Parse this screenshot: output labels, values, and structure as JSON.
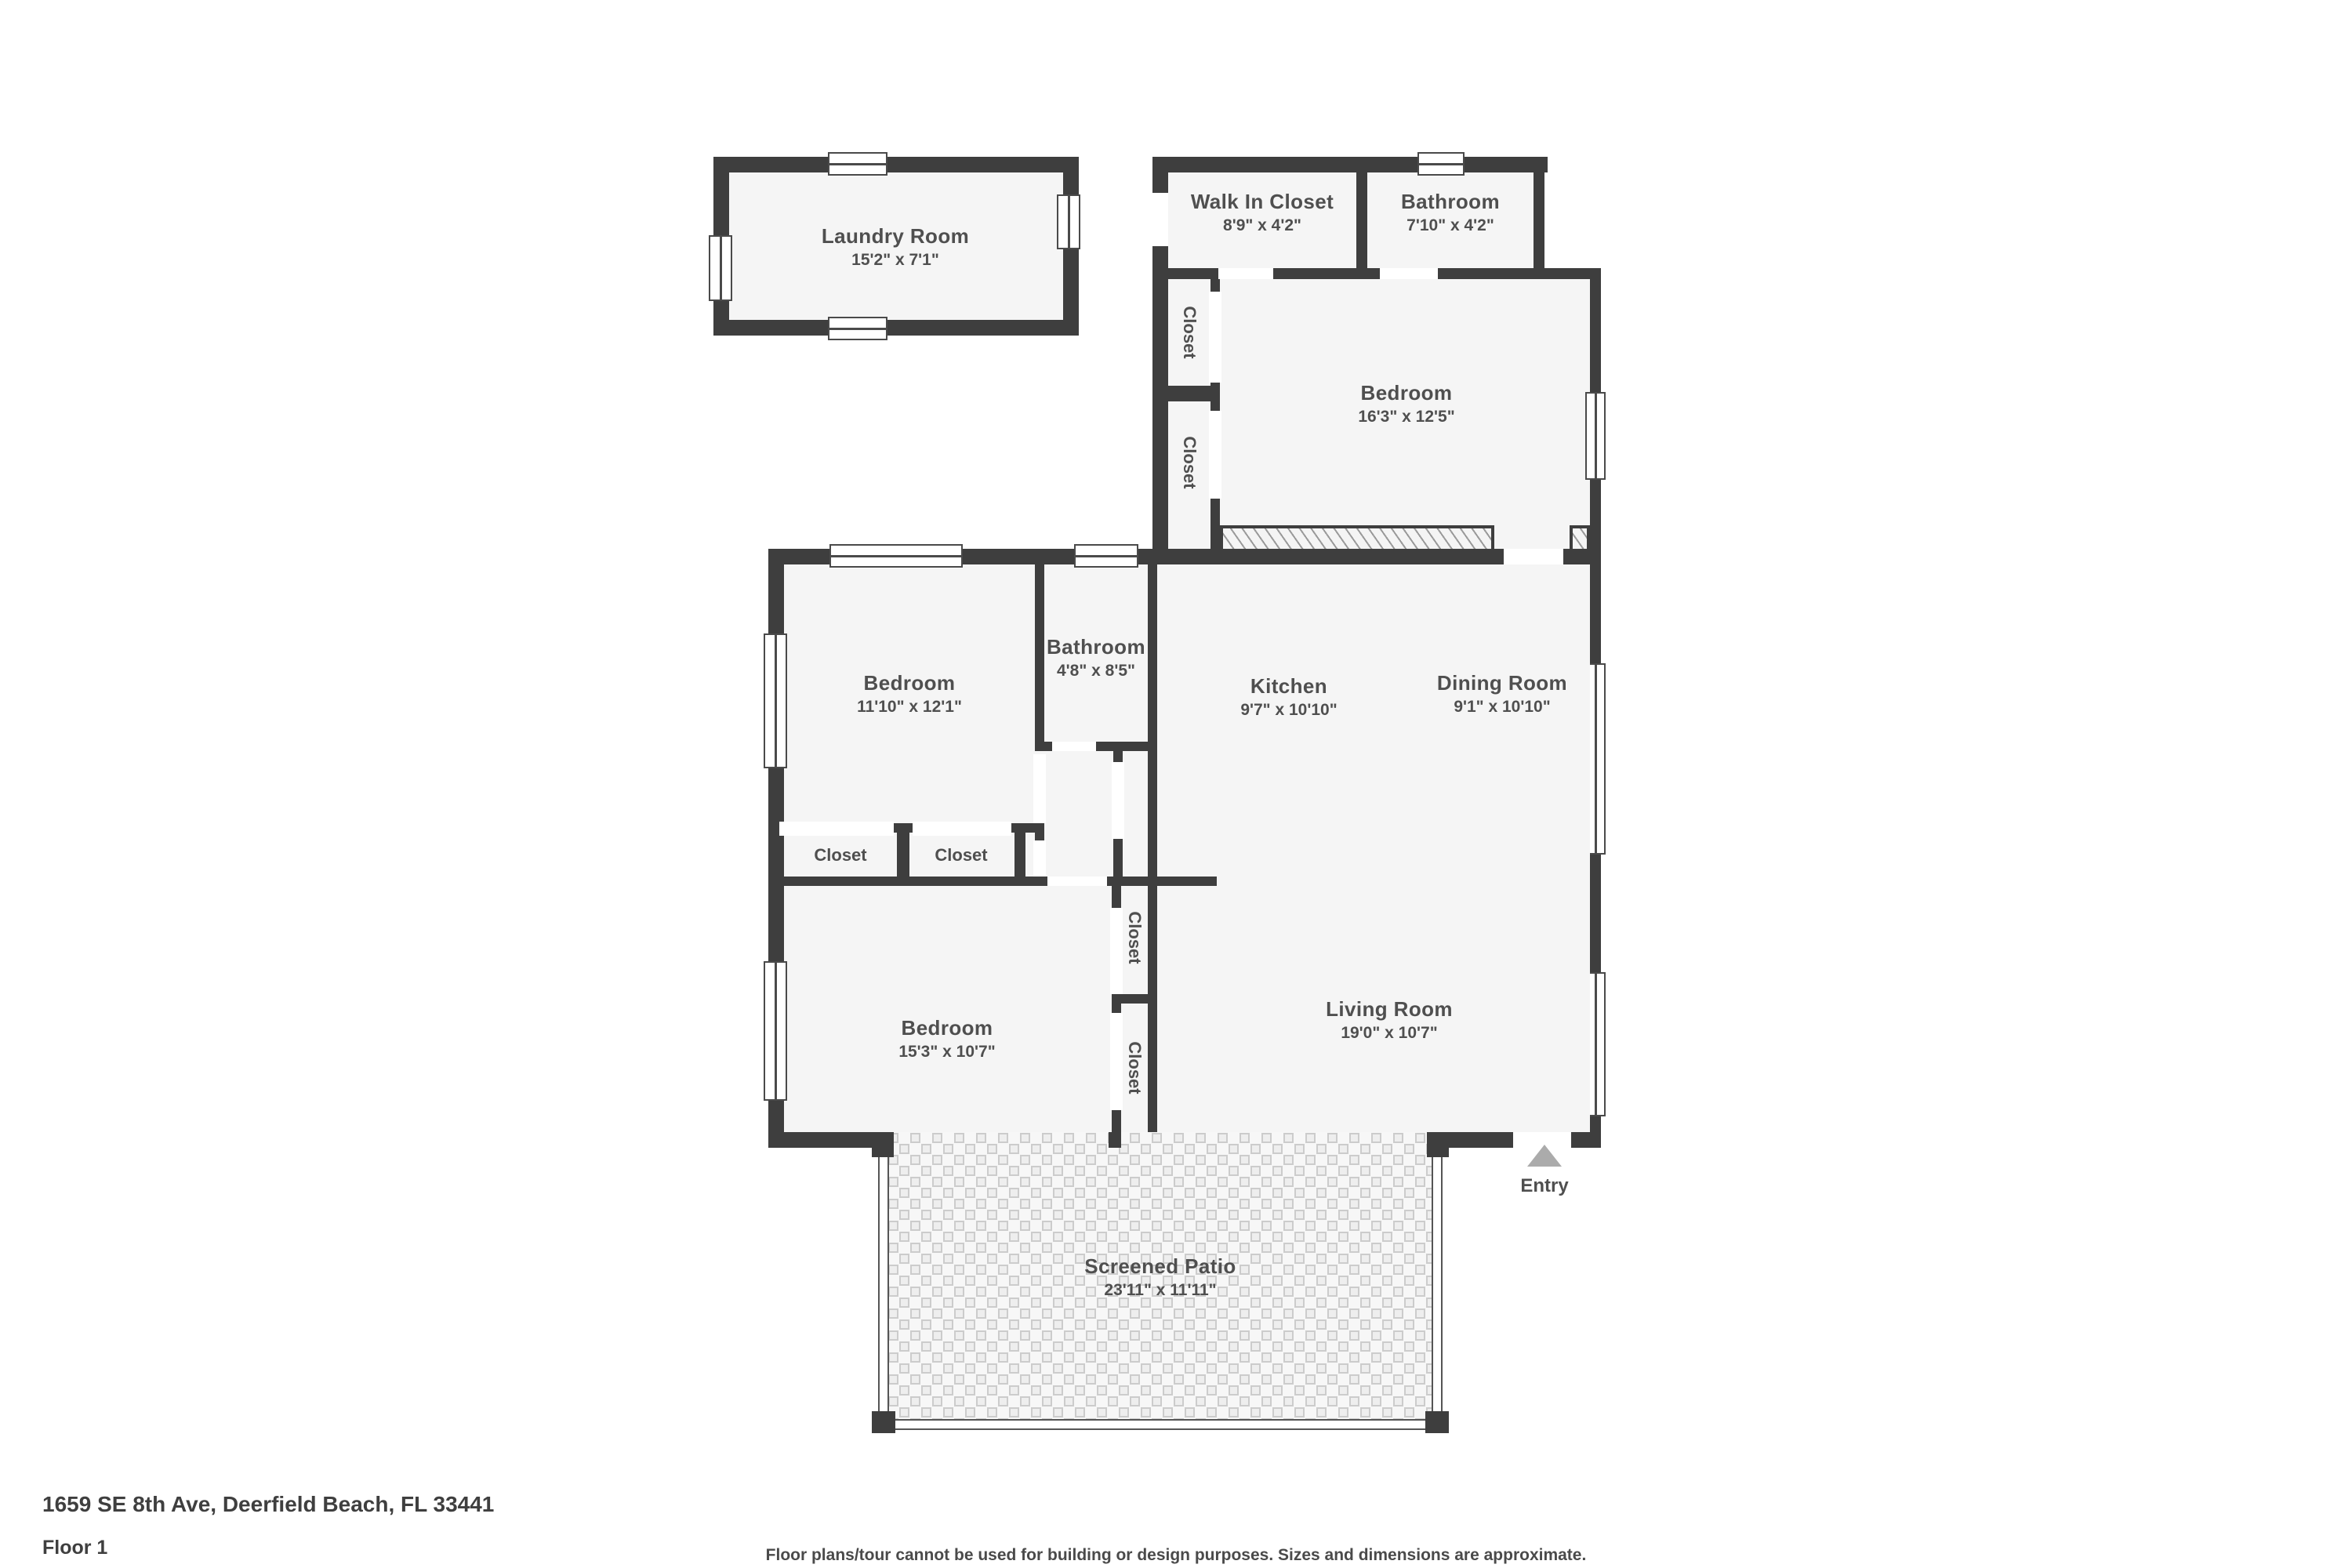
{
  "plan": {
    "rooms": {
      "laundry": {
        "name": "Laundry Room",
        "dims": "15'2\" x 7'1\""
      },
      "walk_in_closet": {
        "name": "Walk In Closet",
        "dims": "8'9\" x 4'2\""
      },
      "bathroom_top": {
        "name": "Bathroom",
        "dims": "7'10\" x 4'2\""
      },
      "bedroom_top": {
        "name": "Bedroom",
        "dims": "16'3\" x 12'5\""
      },
      "bedroom_mid": {
        "name": "Bedroom",
        "dims": "11'10\" x 12'1\""
      },
      "bathroom_small": {
        "name": "Bathroom",
        "dims": "4'8\" x 8'5\""
      },
      "kitchen": {
        "name": "Kitchen",
        "dims": "9'7\" x 10'10\""
      },
      "dining": {
        "name": "Dining Room",
        "dims": "9'1\" x 10'10\""
      },
      "bedroom_bottom": {
        "name": "Bedroom",
        "dims": "15'3\" x 10'7\""
      },
      "living": {
        "name": "Living Room",
        "dims": "19'0\" x 10'7\""
      },
      "patio": {
        "name": "Screened Patio",
        "dims": "23'11\" x 11'11\""
      }
    },
    "closet_label": "Closet",
    "entry_label": "Entry"
  },
  "footer": {
    "address": "1659 SE 8th Ave, Deerfield Beach, FL 33441",
    "floor": "Floor 1",
    "disclaimer": "Floor plans/tour cannot be used for building or design purposes. Sizes and dimensions are approximate."
  },
  "colors": {
    "wall": "#3e3e3e",
    "floor_fill": "#f5f5f5",
    "label_text": "#4f4f4f",
    "entry_arrow": "#ababab",
    "mesh_line": "#cccccc",
    "hatch_line": "#9a9a9a"
  }
}
